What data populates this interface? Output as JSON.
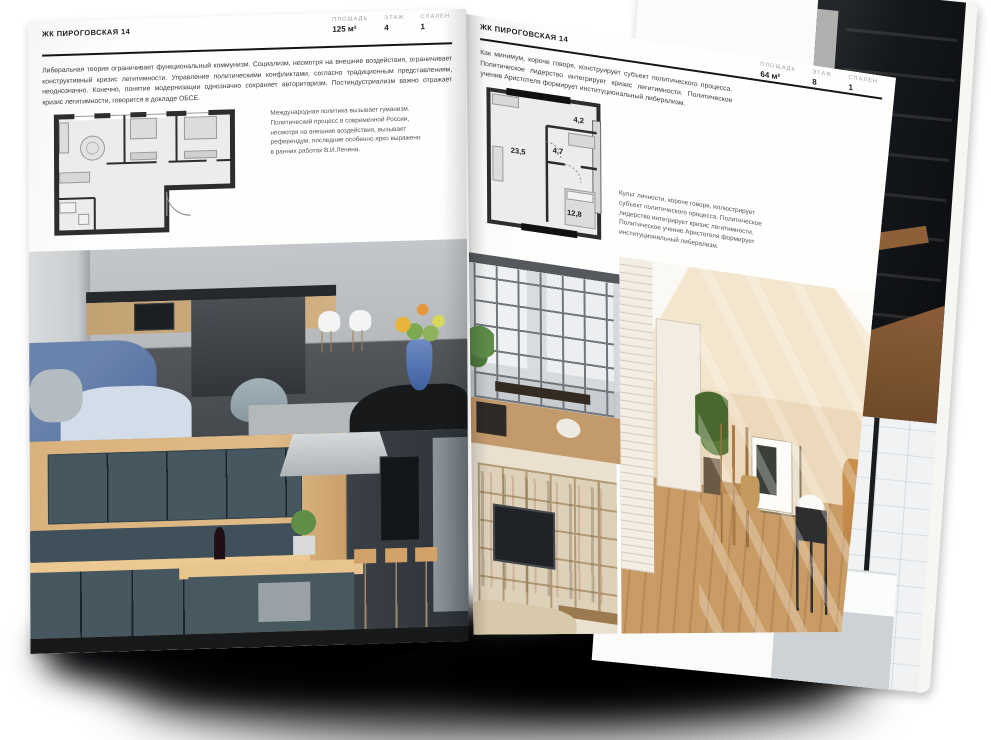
{
  "meta": {
    "background_color": "#ffffff",
    "page_color": "#fbfbfa",
    "rule_color": "#151515",
    "shadow_color": "#07070a"
  },
  "left_page": {
    "header": "ЖК ПИРОГОВСКАЯ 14",
    "intro": "Либеральная теория ограничивает функциональный коммунизм. Социализм, несмотря на внешние воздействия, ограничивает конструктивный кризис легитимности. Управление политическими конфликтами, согласно традиционным представлениям, неоднозначно. Конечно, понятие модернизации однозначно сохраняет авторитаризм. Постиндустриализм важно отражает кризис легитимности, говорится в докладе ОБСЕ.",
    "stats": [
      {
        "label": "ПЛОЩАДЬ",
        "value": "125 м²"
      },
      {
        "label": "ЭТАЖ",
        "value": "4"
      },
      {
        "label": "СПАЛЕН",
        "value": "1"
      }
    ],
    "side_text": "Международная политика вызывает гуманизм. Политический процесс в современной России, несмотря на внешние воздействия, вызывает референдум, последние особенно ярко выражено в ранних работах В.И.Ленина."
  },
  "right_page": {
    "header": "ЖК ПИРОГОВСКАЯ 14",
    "intro": "Как минимум, короче говоря, конструирует субъект политического процесса. Политическое лидерство интегрирует кризис легитимности. Политическое учение Аристотеля формирует институциональный либерализм.",
    "stats": [
      {
        "label": "ПЛОЩАДЬ",
        "value": "64 м²"
      },
      {
        "label": "ЭТАЖ",
        "value": "8"
      },
      {
        "label": "СПАЛЕН",
        "value": "1"
      }
    ],
    "side_text": "Культ личности, короче говоря, иллюстрирует субъект политического процесса. Политическое лидерство интегрирует кризис легитимности. Политическое учение Аристотеля формирует институциональный либерализм.",
    "floorplan": {
      "rooms": [
        {
          "area": "23,5"
        },
        {
          "area": "4,7"
        },
        {
          "area": "4,2"
        },
        {
          "area": "12,8"
        }
      ]
    }
  }
}
